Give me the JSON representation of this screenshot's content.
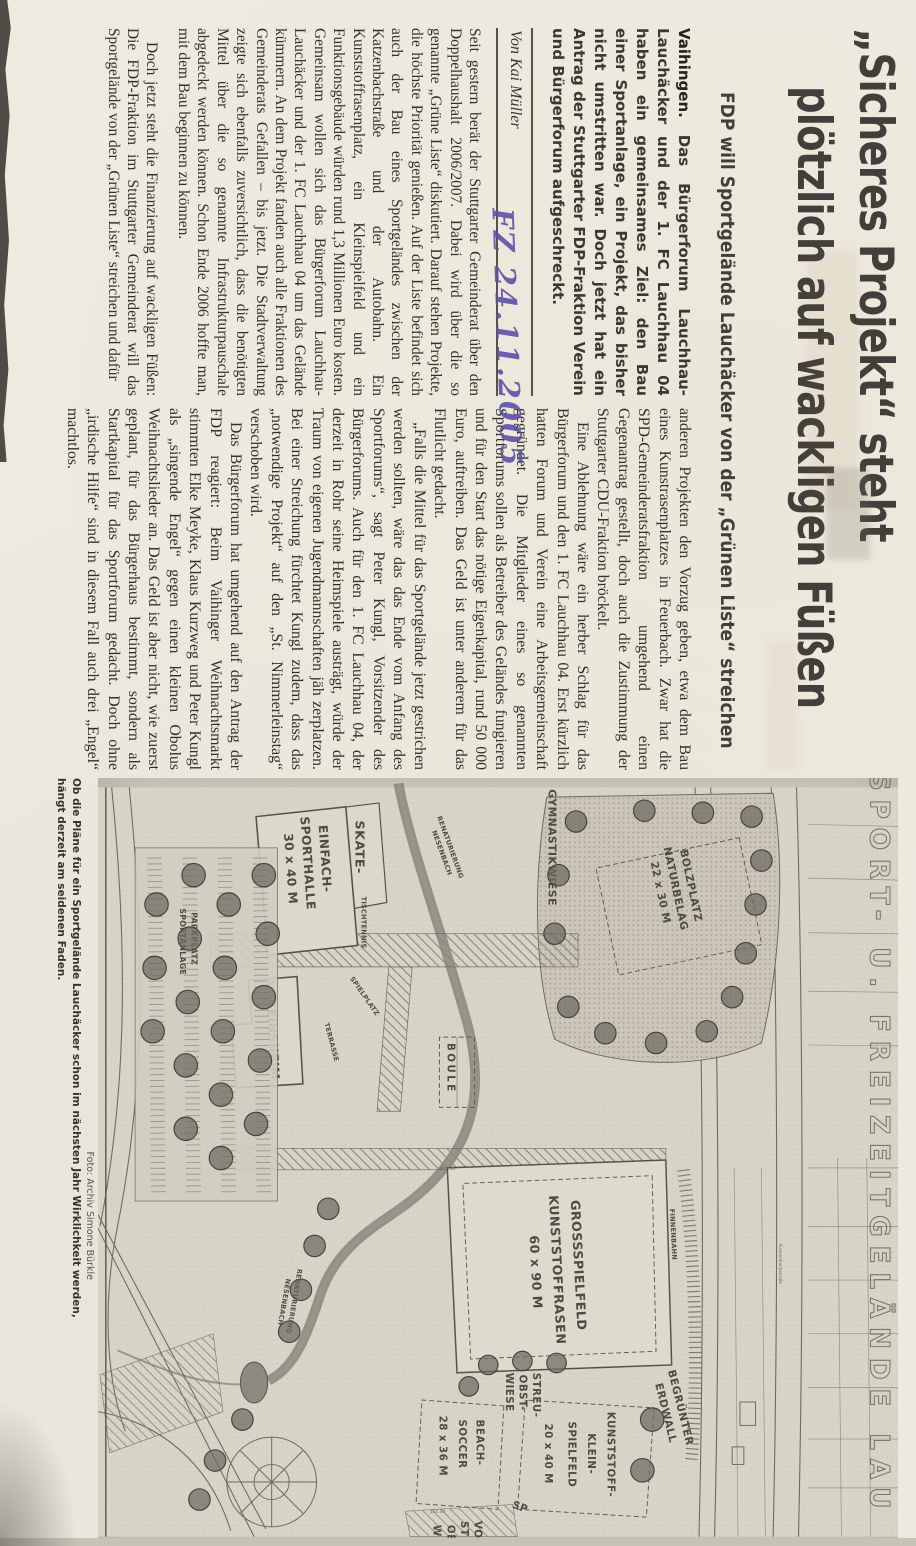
{
  "annotations": {
    "handwritten_date": "FZ 24.11.2005"
  },
  "headline": {
    "line1": "„Sicheres Projekt“ steht",
    "line2": "plötzlich auf wackligen Füßen"
  },
  "subtitle": "FDP will Sportgelände Lauchäcker von der „Grünen Liste“ streichen",
  "byline": "Von Kai Müller",
  "lede": {
    "location": "Vaihingen.",
    "text": "Das Bürgerforum Lauchhau-Lauchäcker und der 1. FC Lauchhau 04 haben ein gemeinsames Ziel: den Bau einer Sportanlage, ein Projekt, das bisher nicht umstritten war. Doch jetzt hat ein Antrag der Stuttgarter FDP-Fraktion Verein und Bürgerforum aufgeschreckt."
  },
  "article": {
    "col1": [
      "Seit gestern berät der Stuttgarter Gemeinderat über den Doppelhaushalt 2006/2007. Dabei wird über die so genannte „Grüne Liste“ diskutiert. Darauf stehen Projekte, die höchste Priorität genießen. Auf der Liste befindet sich auch der Bau eines Sportgeländes zwischen der Katzenbachstraße und der Autobahn. Ein Kunststoffrasenplatz, ein Kleinspielfeld und ein Funktionsgebäude würden rund 1,3 Millionen Euro kosten. Gemeinsam wollen sich das Bürgerforum Lauchhau-Lauchäcker und der 1. FC Lauchhau 04 um das Gelände kümmern. An dem Projekt fanden auch alle Fraktionen des Gemeinderats Gefallen – bis jetzt. Die Stadtverwaltung zeigte sich ebenfalls zuversichtlich, dass die benötigten Mittel über die so genannte Infrastrukturpauschale abgedeckt werden können. Schon Ende 2006 hoffte man, mit dem Bau beginnen zu können.",
      "Doch jetzt steht die Finanzierung auf wackligen Füßen: Die FDP-Fraktion im Stuttgarter Gemeinderat will das Sportgelände von der „Grünen Liste“ streichen und dafür"
    ],
    "col2": [
      "anderen Projekten den Vorzug geben, etwa dem Bau eines Kunstrasenplatzes in Feuerbach. Zwar hat die SPD-Gemeinderatsfraktion umgehend einen Gegenantrag gestellt, doch auch die Zustimmung der Stuttgarter CDU-Fraktion bröckelt.",
      "Eine Ablehnung wäre ein herber Schlag für das Bürgerforum und den 1. FC Lauchhau 04. Erst kürzlich hatten Forum und Verein eine Arbeitsgemeinschaft gegründet. Die Mitglieder eines so genannten Sportforums sollen als Betreiber des Geländes fungieren und für den Start das nötige Eigenkapital, rund 50 000 Euro, auftreiben. Das Geld ist unter anderem für das Flutlicht gedacht.",
      "„Falls die Mittel für das Sportgelände jetzt gestrichen werden sollten, wäre das das Ende vom Anfang des Sportforums“, sagt Peter Kungl, Vorsitzender des Bürgerforums. Auch für den 1. FC Lauchhau 04, der derzeit in Rohr seine Heimspiele austrägt, würde der Traum von eigenen Jugendmannschaften jäh zerplatzen. Bei einer Streichung fürchtet Kungl zudem, dass das „notwendige Projekt“ auf den „St. Nimmerleinstag“ verschoben wird.",
      "Das Bürgerforum hat umgehend auf den Antrag der FDP reagiert: Beim Vaihinger Weihnachtsmarkt stimmten Elke Meyke, Klaus Kurzweg und Peter Kungl als „singende Engel“ gegen einen kleinen Obolus Weihnachtslieder an. Das Geld ist aber nicht, wie zuerst geplant, für das Bürgerhaus bestimmt, sondern als Startkapital für das Sportforum gedacht. Doch ohne „irdische Hilfe“ sind in diesem Fall auch drei „Engel“ machtlos."
    ]
  },
  "photo": {
    "credit": "Foto: Archiv Simone Bürkle",
    "caption_line1": "Ob die Pläne für ein Sportgelände Lauchäcker schon im nächsten Jahr Wirklichkeit werden,",
    "caption_line2": "hängt derzeit am seidenen Faden."
  },
  "map": {
    "title_outline": "SPORT- U. FREIZEITGELÄNDE LAU",
    "labels": {
      "gymnastikwiese": "GYMNASTIKWIESE",
      "bolzplatz": [
        "BOLZPLATZ",
        "NATURBELAG",
        "22 x 30 M"
      ],
      "renaturierung": [
        "RENATURIERUNG",
        "NESENBACH"
      ],
      "skatepark": [
        "SKATE-",
        "PARK"
      ],
      "tischtennis": "TISCHTENNIS",
      "sporthalle": [
        "EINFACH-",
        "SPORTHALLE",
        "30 x 40 M"
      ],
      "vereinsheim": "VEREINSHEIM",
      "spielplatz": "SPIELPLATZ",
      "terrasse": "TERRASSE",
      "boule": "BOULE",
      "finnenbahn": "FINNENBAHN",
      "grossspielfeld": [
        "GROSSSPIELFELD",
        "KUNSTSTOFFRASEN",
        "60 x 90 M"
      ],
      "erdwall": [
        "BEGRÜNTER",
        "ERDWALL"
      ],
      "kleinspielfeld": [
        "KUNSTSTOFF-",
        "KLEIN-",
        "SPIELFELD",
        "20 x 40 M"
      ],
      "streuobstwiese": [
        "STREU-",
        "OBST-",
        "WIESE"
      ],
      "beachsoccer": [
        "BEACH-",
        "SOCCER",
        "28 x 36 M"
      ],
      "parkplatz": [
        "PARKPLATZ",
        "SPORTANLAGE"
      ],
      "strasse": "Katzenbachstraße",
      "cut_labels": [
        "VO",
        "ST",
        "OB",
        "W",
        "SP"
      ],
      "elevations": [
        "461.50",
        "451.50"
      ]
    }
  },
  "colors": {
    "paper": "#edebe0",
    "ink": "#33312c",
    "headline": "#413f39",
    "handwriting": "#5b51a6",
    "map_paper": "#d8d4c8",
    "map_ink": "#5f5c54"
  }
}
